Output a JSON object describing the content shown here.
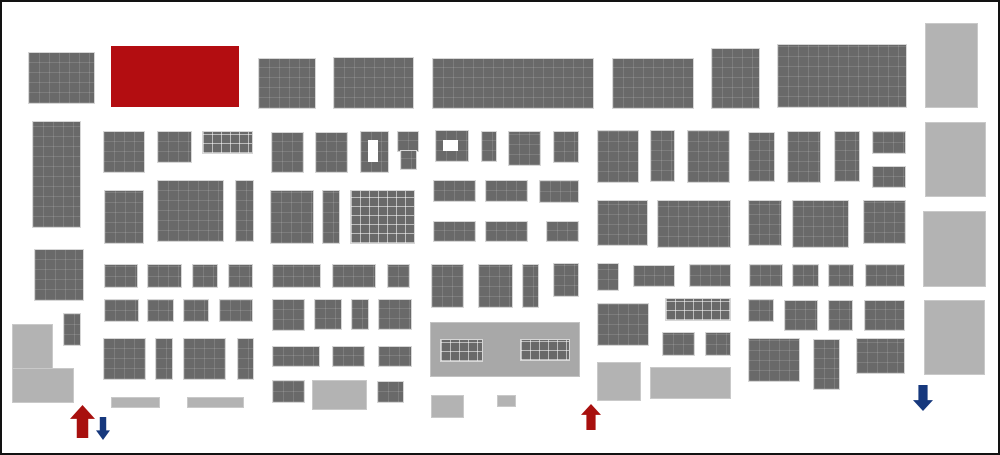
{
  "canvas": {
    "width": 1000,
    "height": 455,
    "background": "#ffffff",
    "border_color": "#121212"
  },
  "colors": {
    "booth": "#696969",
    "booth-border": "#d6d6d6",
    "facility": "#b3b3b3",
    "facility-border": "#c9c9c9",
    "structure": "#a8a8a8",
    "highlight": "#b30d11",
    "arrow-red": "#a8100e",
    "arrow-blue": "#16387d"
  },
  "blocks": [
    {
      "x": 29,
      "y": 53,
      "w": 65,
      "h": 50,
      "t": "d"
    },
    {
      "x": 111,
      "y": 46,
      "w": 128,
      "h": 61,
      "t": "r"
    },
    {
      "x": 259,
      "y": 59,
      "w": 56,
      "h": 49,
      "t": "d"
    },
    {
      "x": 334,
      "y": 58,
      "w": 79,
      "h": 50,
      "t": "d"
    },
    {
      "x": 433,
      "y": 59,
      "w": 160,
      "h": 49,
      "t": "d"
    },
    {
      "x": 613,
      "y": 59,
      "w": 80,
      "h": 49,
      "t": "d"
    },
    {
      "x": 712,
      "y": 49,
      "w": 47,
      "h": 59,
      "t": "d"
    },
    {
      "x": 778,
      "y": 45,
      "w": 128,
      "h": 62,
      "t": "d"
    },
    {
      "x": 33,
      "y": 122,
      "w": 47,
      "h": 105,
      "t": "d"
    },
    {
      "x": 104,
      "y": 132,
      "w": 40,
      "h": 40,
      "t": "d"
    },
    {
      "x": 158,
      "y": 132,
      "w": 33,
      "h": 30,
      "t": "d"
    },
    {
      "x": 203,
      "y": 132,
      "w": 49,
      "h": 21,
      "t": "d",
      "g": 1
    },
    {
      "x": 272,
      "y": 133,
      "w": 31,
      "h": 39,
      "t": "d"
    },
    {
      "x": 316,
      "y": 133,
      "w": 31,
      "h": 39,
      "t": "d"
    },
    {
      "x": 361,
      "y": 132,
      "w": 27,
      "h": 40,
      "t": "d"
    },
    {
      "x": 398,
      "y": 132,
      "w": 20,
      "h": 19,
      "t": "d"
    },
    {
      "x": 401,
      "y": 151,
      "w": 15,
      "h": 18,
      "t": "d"
    },
    {
      "x": 436,
      "y": 131,
      "w": 32,
      "h": 30,
      "t": "d"
    },
    {
      "x": 482,
      "y": 132,
      "w": 14,
      "h": 29,
      "t": "d"
    },
    {
      "x": 509,
      "y": 132,
      "w": 31,
      "h": 33,
      "t": "d"
    },
    {
      "x": 554,
      "y": 132,
      "w": 24,
      "h": 30,
      "t": "d"
    },
    {
      "x": 598,
      "y": 131,
      "w": 40,
      "h": 51,
      "t": "d"
    },
    {
      "x": 651,
      "y": 131,
      "w": 23,
      "h": 50,
      "t": "d"
    },
    {
      "x": 688,
      "y": 131,
      "w": 41,
      "h": 51,
      "t": "d"
    },
    {
      "x": 749,
      "y": 133,
      "w": 25,
      "h": 48,
      "t": "d"
    },
    {
      "x": 788,
      "y": 132,
      "w": 32,
      "h": 50,
      "t": "d"
    },
    {
      "x": 835,
      "y": 132,
      "w": 24,
      "h": 49,
      "t": "d"
    },
    {
      "x": 873,
      "y": 132,
      "w": 32,
      "h": 21,
      "t": "d"
    },
    {
      "x": 873,
      "y": 167,
      "w": 32,
      "h": 20,
      "t": "d"
    },
    {
      "x": 105,
      "y": 191,
      "w": 38,
      "h": 52,
      "t": "d"
    },
    {
      "x": 158,
      "y": 181,
      "w": 65,
      "h": 60,
      "t": "d"
    },
    {
      "x": 236,
      "y": 181,
      "w": 17,
      "h": 60,
      "t": "d"
    },
    {
      "x": 271,
      "y": 191,
      "w": 42,
      "h": 52,
      "t": "d"
    },
    {
      "x": 323,
      "y": 191,
      "w": 16,
      "h": 52,
      "t": "d"
    },
    {
      "x": 351,
      "y": 191,
      "w": 63,
      "h": 52,
      "t": "d",
      "g": 1
    },
    {
      "x": 434,
      "y": 181,
      "w": 41,
      "h": 20,
      "t": "d"
    },
    {
      "x": 486,
      "y": 181,
      "w": 41,
      "h": 20,
      "t": "d"
    },
    {
      "x": 540,
      "y": 181,
      "w": 38,
      "h": 21,
      "t": "d"
    },
    {
      "x": 434,
      "y": 222,
      "w": 41,
      "h": 19,
      "t": "d"
    },
    {
      "x": 486,
      "y": 222,
      "w": 41,
      "h": 19,
      "t": "d"
    },
    {
      "x": 547,
      "y": 222,
      "w": 31,
      "h": 19,
      "t": "d"
    },
    {
      "x": 598,
      "y": 201,
      "w": 49,
      "h": 44,
      "t": "d"
    },
    {
      "x": 658,
      "y": 201,
      "w": 72,
      "h": 46,
      "t": "d"
    },
    {
      "x": 749,
      "y": 201,
      "w": 32,
      "h": 44,
      "t": "d"
    },
    {
      "x": 793,
      "y": 201,
      "w": 55,
      "h": 46,
      "t": "d"
    },
    {
      "x": 864,
      "y": 201,
      "w": 41,
      "h": 42,
      "t": "d"
    },
    {
      "x": 35,
      "y": 250,
      "w": 48,
      "h": 50,
      "t": "d"
    },
    {
      "x": 105,
      "y": 265,
      "w": 32,
      "h": 22,
      "t": "d"
    },
    {
      "x": 148,
      "y": 265,
      "w": 33,
      "h": 22,
      "t": "d"
    },
    {
      "x": 193,
      "y": 265,
      "w": 24,
      "h": 22,
      "t": "d"
    },
    {
      "x": 229,
      "y": 265,
      "w": 23,
      "h": 22,
      "t": "d"
    },
    {
      "x": 273,
      "y": 265,
      "w": 47,
      "h": 22,
      "t": "d"
    },
    {
      "x": 333,
      "y": 265,
      "w": 42,
      "h": 22,
      "t": "d"
    },
    {
      "x": 388,
      "y": 265,
      "w": 21,
      "h": 22,
      "t": "d"
    },
    {
      "x": 432,
      "y": 265,
      "w": 31,
      "h": 42,
      "t": "d"
    },
    {
      "x": 479,
      "y": 265,
      "w": 33,
      "h": 42,
      "t": "d"
    },
    {
      "x": 523,
      "y": 265,
      "w": 15,
      "h": 42,
      "t": "d"
    },
    {
      "x": 554,
      "y": 264,
      "w": 24,
      "h": 32,
      "t": "d"
    },
    {
      "x": 598,
      "y": 264,
      "w": 20,
      "h": 26,
      "t": "d"
    },
    {
      "x": 634,
      "y": 266,
      "w": 40,
      "h": 20,
      "t": "d"
    },
    {
      "x": 690,
      "y": 265,
      "w": 40,
      "h": 21,
      "t": "d"
    },
    {
      "x": 750,
      "y": 265,
      "w": 32,
      "h": 21,
      "t": "d"
    },
    {
      "x": 793,
      "y": 265,
      "w": 25,
      "h": 21,
      "t": "d"
    },
    {
      "x": 829,
      "y": 265,
      "w": 24,
      "h": 21,
      "t": "d"
    },
    {
      "x": 866,
      "y": 265,
      "w": 38,
      "h": 21,
      "t": "d"
    },
    {
      "x": 105,
      "y": 300,
      "w": 33,
      "h": 21,
      "t": "d"
    },
    {
      "x": 148,
      "y": 300,
      "w": 25,
      "h": 21,
      "t": "d"
    },
    {
      "x": 184,
      "y": 300,
      "w": 24,
      "h": 21,
      "t": "d"
    },
    {
      "x": 220,
      "y": 300,
      "w": 32,
      "h": 21,
      "t": "d"
    },
    {
      "x": 273,
      "y": 300,
      "w": 31,
      "h": 30,
      "t": "d"
    },
    {
      "x": 315,
      "y": 300,
      "w": 26,
      "h": 29,
      "t": "d"
    },
    {
      "x": 352,
      "y": 300,
      "w": 16,
      "h": 29,
      "t": "d"
    },
    {
      "x": 379,
      "y": 300,
      "w": 32,
      "h": 29,
      "t": "d"
    },
    {
      "x": 598,
      "y": 304,
      "w": 50,
      "h": 41,
      "t": "d"
    },
    {
      "x": 666,
      "y": 299,
      "w": 64,
      "h": 21,
      "t": "d",
      "g": 1
    },
    {
      "x": 749,
      "y": 300,
      "w": 24,
      "h": 21,
      "t": "d"
    },
    {
      "x": 785,
      "y": 301,
      "w": 32,
      "h": 29,
      "t": "d"
    },
    {
      "x": 829,
      "y": 301,
      "w": 23,
      "h": 29,
      "t": "d"
    },
    {
      "x": 865,
      "y": 301,
      "w": 39,
      "h": 29,
      "t": "d"
    },
    {
      "x": 64,
      "y": 314,
      "w": 16,
      "h": 31,
      "t": "d"
    },
    {
      "x": 104,
      "y": 339,
      "w": 41,
      "h": 40,
      "t": "d"
    },
    {
      "x": 156,
      "y": 339,
      "w": 16,
      "h": 40,
      "t": "d"
    },
    {
      "x": 184,
      "y": 339,
      "w": 41,
      "h": 40,
      "t": "d"
    },
    {
      "x": 238,
      "y": 339,
      "w": 15,
      "h": 40,
      "t": "d"
    },
    {
      "x": 273,
      "y": 347,
      "w": 46,
      "h": 19,
      "t": "d"
    },
    {
      "x": 333,
      "y": 347,
      "w": 31,
      "h": 19,
      "t": "d"
    },
    {
      "x": 379,
      "y": 347,
      "w": 32,
      "h": 19,
      "t": "d"
    },
    {
      "x": 663,
      "y": 333,
      "w": 31,
      "h": 22,
      "t": "d"
    },
    {
      "x": 706,
      "y": 333,
      "w": 24,
      "h": 22,
      "t": "d"
    },
    {
      "x": 749,
      "y": 339,
      "w": 50,
      "h": 42,
      "t": "d"
    },
    {
      "x": 814,
      "y": 340,
      "w": 25,
      "h": 49,
      "t": "d"
    },
    {
      "x": 857,
      "y": 339,
      "w": 47,
      "h": 34,
      "t": "d"
    },
    {
      "x": 273,
      "y": 381,
      "w": 31,
      "h": 21,
      "t": "d"
    },
    {
      "x": 378,
      "y": 382,
      "w": 25,
      "h": 20,
      "t": "d"
    },
    {
      "x": 431,
      "y": 323,
      "w": 148,
      "h": 53,
      "t": "c"
    },
    {
      "x": 441,
      "y": 340,
      "w": 41,
      "h": 21,
      "t": "d",
      "g": 1
    },
    {
      "x": 521,
      "y": 340,
      "w": 48,
      "h": 20,
      "t": "d",
      "g": 1
    },
    {
      "x": 13,
      "y": 325,
      "w": 39,
      "h": 44,
      "t": "l"
    },
    {
      "x": 13,
      "y": 369,
      "w": 60,
      "h": 33,
      "t": "l"
    },
    {
      "x": 112,
      "y": 398,
      "w": 47,
      "h": 9,
      "t": "l"
    },
    {
      "x": 188,
      "y": 398,
      "w": 55,
      "h": 9,
      "t": "l"
    },
    {
      "x": 313,
      "y": 381,
      "w": 53,
      "h": 28,
      "t": "l"
    },
    {
      "x": 432,
      "y": 396,
      "w": 31,
      "h": 21,
      "t": "l"
    },
    {
      "x": 498,
      "y": 396,
      "w": 17,
      "h": 10,
      "t": "l"
    },
    {
      "x": 598,
      "y": 363,
      "w": 42,
      "h": 37,
      "t": "l"
    },
    {
      "x": 651,
      "y": 368,
      "w": 79,
      "h": 30,
      "t": "l"
    },
    {
      "x": 926,
      "y": 24,
      "w": 51,
      "h": 83,
      "t": "l"
    },
    {
      "x": 926,
      "y": 123,
      "w": 59,
      "h": 73,
      "t": "l"
    },
    {
      "x": 924,
      "y": 212,
      "w": 61,
      "h": 74,
      "t": "l"
    },
    {
      "x": 925,
      "y": 301,
      "w": 59,
      "h": 73,
      "t": "l"
    }
  ],
  "holes": [
    {
      "x": 368,
      "y": 140,
      "w": 10,
      "h": 22
    },
    {
      "x": 443,
      "y": 140,
      "w": 15,
      "h": 11
    }
  ],
  "arrows": [
    {
      "x": 70,
      "y": 405,
      "w": 25,
      "h": 33,
      "dir": "up",
      "color": "red"
    },
    {
      "x": 96,
      "y": 417,
      "w": 14,
      "h": 23,
      "dir": "down",
      "color": "blue"
    },
    {
      "x": 581,
      "y": 404,
      "w": 20,
      "h": 26,
      "dir": "up",
      "color": "red"
    },
    {
      "x": 913,
      "y": 385,
      "w": 20,
      "h": 26,
      "dir": "down",
      "color": "blue"
    }
  ]
}
